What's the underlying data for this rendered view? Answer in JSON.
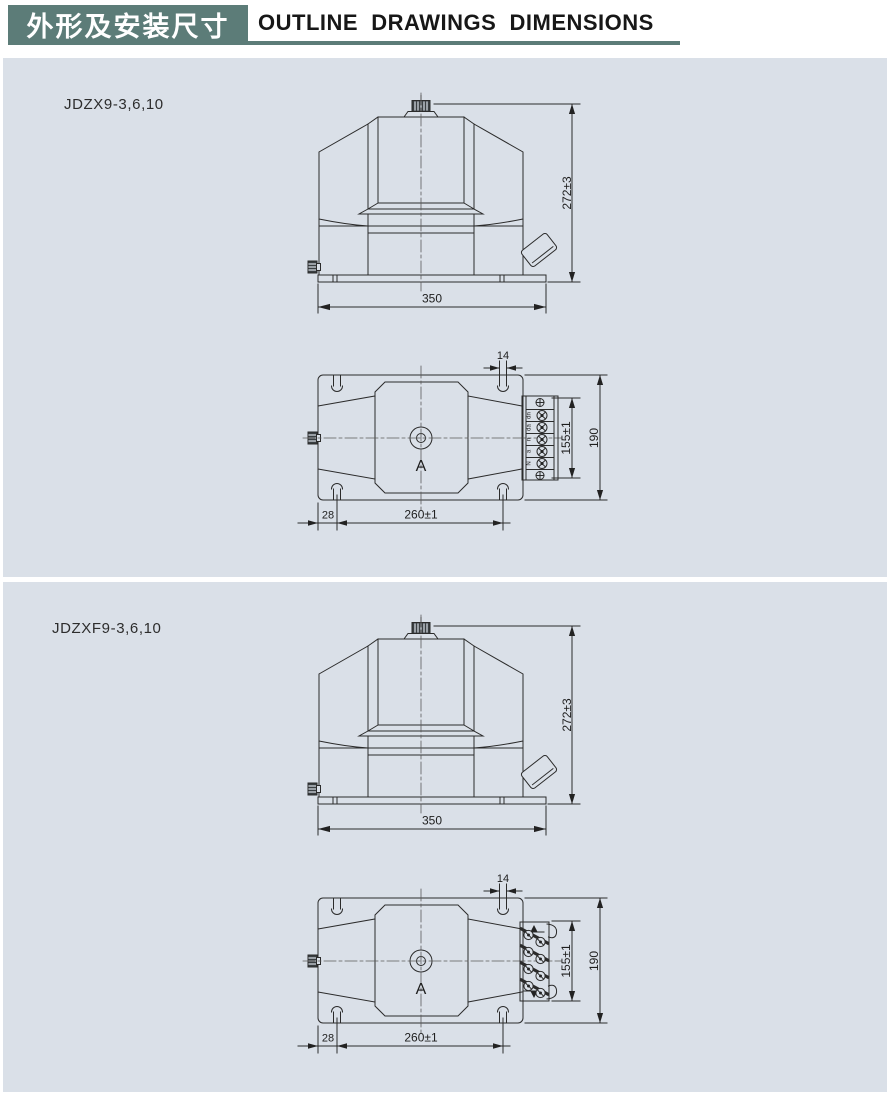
{
  "header": {
    "title_zh": "外形及安装尺寸",
    "title_en": "OUTLINE  DRAWINGS  DIMENSIONS"
  },
  "colors": {
    "accent_teal": "#5c7c78",
    "panel_background": "#dae0e8",
    "line": "#2b2b2b"
  },
  "sections": [
    {
      "model": "JDZX9-3,6,10",
      "front": {
        "height_dim": "272±3",
        "width_dim": "350"
      },
      "top": {
        "slot_dim": "14",
        "terminal_dim": "155±1",
        "depth_dim": "190",
        "offset_dim": "28",
        "spacing_dim": "260±1",
        "core_label": "A"
      },
      "terminal_labels": [
        "dn",
        "da",
        "n",
        "a",
        "N"
      ]
    },
    {
      "model": "JDZXF9-3,6,10",
      "front": {
        "height_dim": "272±3",
        "width_dim": "350"
      },
      "top": {
        "slot_dim": "14",
        "terminal_dim": "155±1",
        "depth_dim": "190",
        "offset_dim": "28",
        "spacing_dim": "260±1",
        "core_label": "A"
      }
    }
  ]
}
